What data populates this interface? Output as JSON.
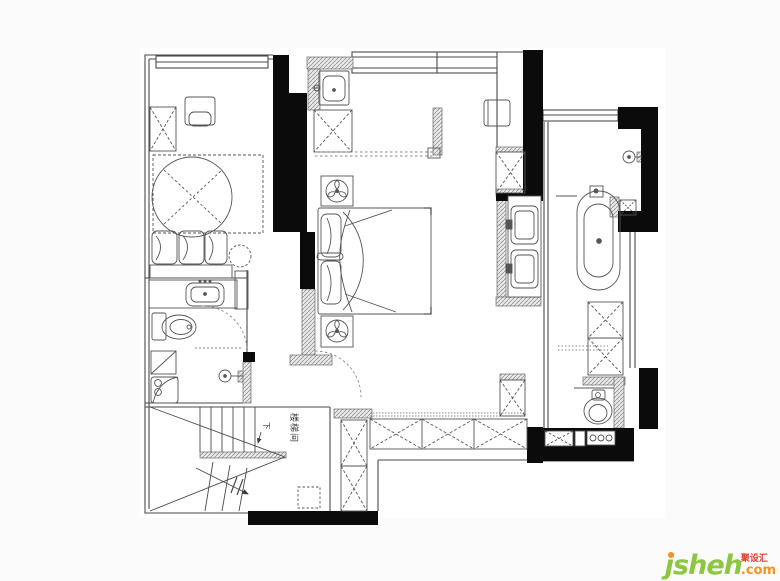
{
  "canvas": {
    "background": "#fbfbfb",
    "paper": "#ffffff"
  },
  "plan": {
    "line_color": "#4a4a4a",
    "wall_color": "#0b0b0b",
    "hatch_color": "#8a8a8a",
    "labels": {
      "stairwell": "楼梯间",
      "down": "下"
    },
    "fixtures": [
      "round-bed",
      "double-bed",
      "wardrobe",
      "desk-chair",
      "vanity-sink",
      "toilet",
      "shower-head",
      "washbasin",
      "wall-sink",
      "exhaust-fan",
      "entry-cabinet",
      "double-sink-vanity",
      "freestanding-bathtub",
      "floor-drain",
      "washing-appliances",
      "staircase",
      "corridor-wardrobe"
    ]
  },
  "watermark": {
    "brand": "jsheh",
    "tld": ".com",
    "cn": "聚设汇",
    "brand_color": "#8dc63f",
    "tld_color": "#f6921e",
    "cn_color": "#e63c2f",
    "dot_color": "#f6921e"
  }
}
